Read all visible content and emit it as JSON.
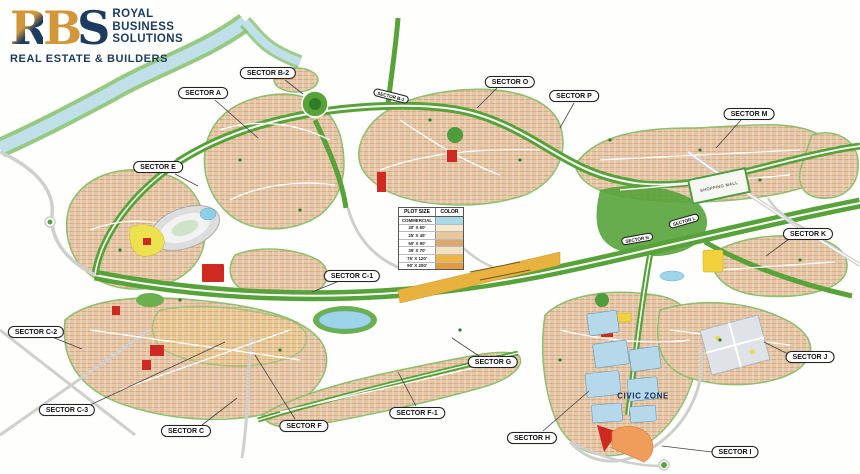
{
  "logo": {
    "m1": "R",
    "m2": "B",
    "m3": "S",
    "line1": "ROYAL",
    "line2": "BUSINESS",
    "line3": "SOLUTIONS",
    "tagline": "REAL ESTATE & BUILDERS",
    "navy": "#1d3a5f",
    "gold": "#d2973a"
  },
  "legend": {
    "header_plot": "PLOT SIZE",
    "header_color": "COLOR",
    "rows": [
      {
        "label": "COMMERCIAL",
        "color": "#a9d9e6"
      },
      {
        "label": "30' X 60'",
        "color": "#f2e9cf"
      },
      {
        "label": "25' X 45'",
        "color": "#e6c89a"
      },
      {
        "label": "50' X 90'",
        "color": "#d9a96e"
      },
      {
        "label": "35' X 70'",
        "color": "#f0e2c0"
      },
      {
        "label": "75' X 120'",
        "color": "#ecb546"
      },
      {
        "label": "90' X 200'",
        "color": "#e69a40"
      }
    ]
  },
  "map": {
    "sectors": [
      {
        "label": "SECTOR A"
      },
      {
        "label": "SECTOR B-2"
      },
      {
        "label": "SECTOR O"
      },
      {
        "label": "SECTOR P"
      },
      {
        "label": "SECTOR M"
      },
      {
        "label": "SECTOR E"
      },
      {
        "label": "SECTOR K"
      },
      {
        "label": "SECTOR C-1"
      },
      {
        "label": "SECTOR C-2"
      },
      {
        "label": "SECTOR J"
      },
      {
        "label": "SECTOR G"
      },
      {
        "label": "SECTOR C-3"
      },
      {
        "label": "SECTOR F-1"
      },
      {
        "label": "SECTOR C"
      },
      {
        "label": "SECTOR F"
      },
      {
        "label": "SECTOR H"
      },
      {
        "label": "SECTOR I"
      },
      {
        "label": "SECTOR B-1"
      },
      {
        "label": "SECTOR L"
      },
      {
        "label": "SECTOR N"
      }
    ],
    "zone_label": "CIVIC ZONE",
    "mall_label": "SHOPPING MALL",
    "colors": {
      "road_green": "#57a33a",
      "residential": "#d8ac80",
      "water": "#9dd4ea",
      "commercial_red": "#cf2a21",
      "accent_yellow": "#f2d23c",
      "civic_blue": "#b5d8ea",
      "strip_orange": "#e9b23e"
    }
  }
}
